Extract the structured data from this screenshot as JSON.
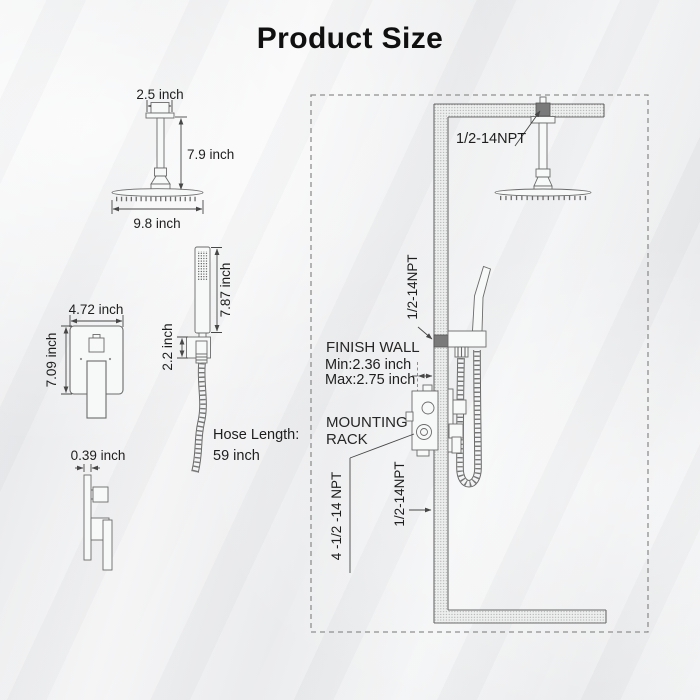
{
  "title": "Product Size",
  "colors": {
    "line": "#6b6b6b",
    "text": "#1e1e1e",
    "dark_fitting": "#7a7a7a",
    "dashed_border": "#8f8f8f",
    "background": "#edeff0"
  },
  "left": {
    "ceiling_shower": {
      "flange_width": "2.5 inch",
      "arm_height": "7.9 inch",
      "head_diameter": "9.8 inch"
    },
    "hand_shower": {
      "wand_length": "7.87 inch",
      "holder_height": "2.2 inch",
      "hose_length_line1": "Hose Length:",
      "hose_length_line2": "59 inch"
    },
    "valve_front": {
      "width": "4.72 inch",
      "height": "7.09 inch"
    },
    "valve_side": {
      "depth": "0.39 inch"
    }
  },
  "right": {
    "ceiling_connection": "1/2-14NPT",
    "handshower_connection": "1/2-14NPT",
    "finish_wall_line1": "FINISH WALL",
    "finish_wall_line2": "Min:2.36 inch",
    "finish_wall_line3": "Max:2.75 inch",
    "mounting_line1": "MOUNTING",
    "mounting_line2": "RACK",
    "valve_connection": "4 -1/2 -14 NPT",
    "supply_connection": "1/2-14NPT"
  }
}
